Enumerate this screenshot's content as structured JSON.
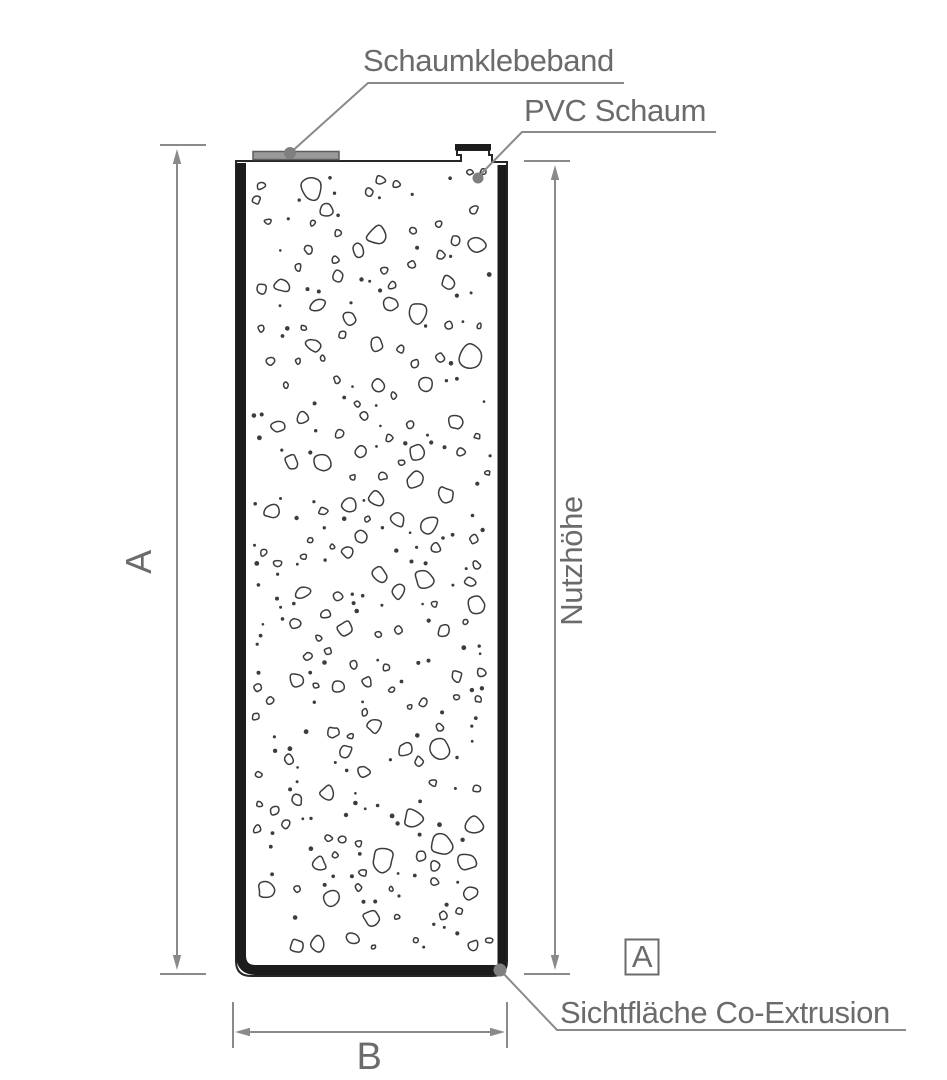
{
  "diagram": {
    "labels": {
      "foam_tape": "Schaumklebeband",
      "pvc_foam": "PVC Schaum",
      "visible_surface": "Sichtfläche Co-Extrusion"
    },
    "dimensions": {
      "overall_height": "A",
      "usable_height": "Nutzhöhe",
      "width": "B"
    },
    "section_marker": "A",
    "colors": {
      "page_bg": "#ffffff",
      "label_text": "#6b6b6b",
      "dimension_line": "#8a8a8a",
      "profile_outline": "#262626",
      "profile_solid": "#1c1c1c",
      "pebble_stroke": "#3c3c3c",
      "tape_fill": "#9a9a9a",
      "tape_border": "#5e5e5e",
      "marker_dot": "#7f7f7f"
    }
  }
}
